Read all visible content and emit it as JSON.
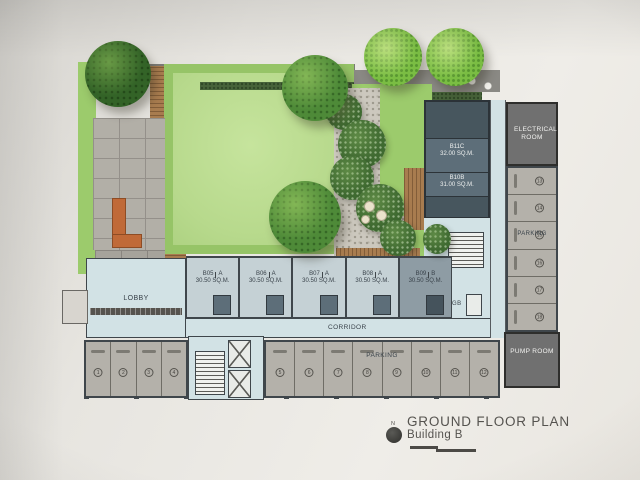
{
  "title_block": {
    "title": "GROUND FLOOR PLAN",
    "subtitle": "Building B",
    "north_symbol": "north-marker"
  },
  "labels": {
    "lobby": "LOBBY",
    "corridor": "CORRIDOR",
    "electrical_room": "ELECTRICAL ROOM",
    "pump_room": "PUMP ROOM",
    "parking_bottom": "PARKING",
    "parking_side": "PARKING",
    "garbage_room": "GB"
  },
  "units": [
    {
      "id": "B05",
      "type": "A",
      "area": "30.50 SQ.M."
    },
    {
      "id": "B06",
      "type": "A",
      "area": "30.50 SQ.M."
    },
    {
      "id": "B07",
      "type": "A",
      "area": "30.50 SQ.M."
    },
    {
      "id": "B08",
      "type": "A",
      "area": "30.50 SQ.M."
    },
    {
      "id": "B09",
      "type": "B",
      "area": "30.50 SQ.M."
    }
  ],
  "upper_units": [
    {
      "id": "B11C",
      "area": "32.00 SQ.M."
    },
    {
      "id": "B10B",
      "area": "31.00 SQ.M."
    }
  ],
  "parking_spaces": {
    "left_row": [
      "1",
      "2",
      "3",
      "4"
    ],
    "bottom_row": [
      "5",
      "6",
      "7",
      "8",
      "9",
      "10",
      "11",
      "12"
    ],
    "side_column": [
      "13",
      "14",
      "15",
      "16",
      "17",
      "18"
    ]
  },
  "colors": {
    "paper": "#e8e5e0",
    "lawn": "#b7d98c",
    "lawn_border": "#96c467",
    "grass": "#9ccb6c",
    "hedge": "#47633a",
    "tree_bright": "#7abd43",
    "deck": "#a87c4f",
    "paver": "#b2afa7",
    "gravel": "#ccc8be",
    "walkway": "#7b7a75",
    "unit_light": "#c5d1d5",
    "unit_dark": "#5d6e79",
    "corridor_blue": "#d2e2e5",
    "wall": "#3f464b",
    "room_gray": "#707070",
    "stall_gray": "#b4b1aa",
    "bench_orange": "#c06a38",
    "text_dark": "#39424a",
    "title_gray": "#55534f"
  }
}
